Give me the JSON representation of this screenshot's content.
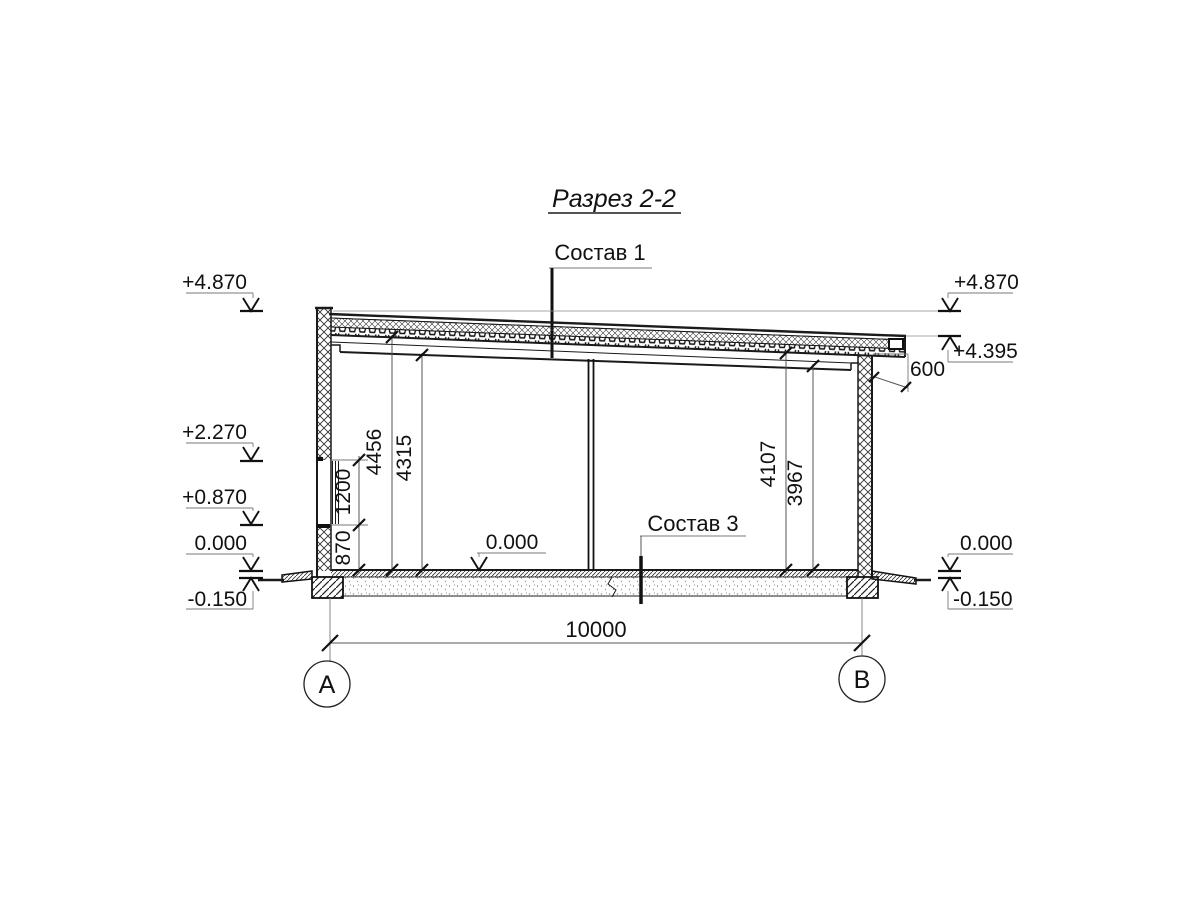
{
  "title": {
    "text": "Разрез 2-2"
  },
  "callouts": {
    "sostav1": "Состав 1",
    "sostav3": "Состав 3"
  },
  "elevation_marks": {
    "left": [
      {
        "value": "+4.870"
      },
      {
        "value": "+2.270"
      },
      {
        "value": "+0.870"
      },
      {
        "value": "0.000"
      },
      {
        "value": "-0.150"
      }
    ],
    "right": [
      {
        "value": "+4.870"
      },
      {
        "value": "+4.395"
      },
      {
        "value": "0.000"
      },
      {
        "value": "-0.150"
      }
    ],
    "interior_floor": "0.000"
  },
  "dimensions": {
    "span_axes": "10000",
    "roof_overhang": "600",
    "left_chain": [
      "870",
      "1200"
    ],
    "left_heights": [
      "4456",
      "4315"
    ],
    "right_heights": [
      "4107",
      "3967"
    ]
  },
  "axes": [
    {
      "label": "А"
    },
    {
      "label": "В"
    }
  ],
  "colors": {
    "line": "#1a1a1a",
    "helper": "#7a7a7a",
    "background": "#ffffff"
  }
}
